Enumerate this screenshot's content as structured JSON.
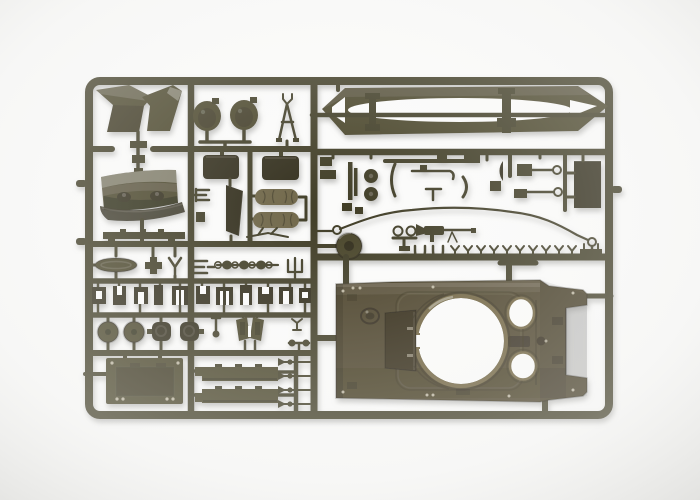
{
  "scene": {
    "type": "product-photo",
    "subject": "olive drab plastic model kit sprue",
    "description": "Product photo of an olive-drab injection-moulded model kit sprue holding tank parts: an upper hull deck with circular turret ring and two hatch openings, a pair of long tapered sand skirts, a dozer blade, stowage boxes, bed rolls, road wheels, a tow cable with end loops, rows of small brackets and fittings, all attached to a rectangular runner frame on a white studio background."
  },
  "palette": {
    "page_bg": "#fbfbfa",
    "vignette_edge": "#dddddb",
    "runner": "#413d28",
    "part_dark": "#322e1c",
    "part_mid": "#4a452c",
    "part_light": "#6d6343",
    "cylinder": "#6e6546",
    "hull": "#4c4329",
    "hull_panel": "#332b18",
    "rim_light": "#6f6440",
    "rivet_dot": "#cfc8b4"
  },
  "parts": [
    {
      "name": "sprue-frame",
      "label": "Rectangular runner frame with rounded corners"
    },
    {
      "name": "runner-rails",
      "label": "Inner runner rails dividing the sprue into bays"
    },
    {
      "name": "fender-wings",
      "label": "Angled fender / mudguard pair (top left)"
    },
    {
      "name": "hatch-discs",
      "label": "Two round hatch discs"
    },
    {
      "name": "mg-tripod",
      "label": "Machine-gun tripod A-frame"
    },
    {
      "name": "sand-skirts",
      "label": "Long tapered sand-skirt blade pair with centre rod"
    },
    {
      "name": "small-fittings",
      "label": "Cluster of small rods, rings, arcs and brackets"
    },
    {
      "name": "tow-cable",
      "label": "Long tow cable with eyelet loops at both ends"
    },
    {
      "name": "cable-pulley",
      "label": "Cable pulley wheel"
    },
    {
      "name": "hull-mg",
      "label": "Small machine gun"
    },
    {
      "name": "end-connector-row",
      "label": "Row of small track end connectors"
    },
    {
      "name": "dozer-blade",
      "label": "Curved dozer blade with hinge bosses"
    },
    {
      "name": "stowage-boxes",
      "label": "Two rounded stowage boxes"
    },
    {
      "name": "bed-rolls",
      "label": "Two rolled tarpaulins"
    },
    {
      "name": "fender-panel",
      "label": "Tall curved fender panel"
    },
    {
      "name": "oval-base-plate",
      "label": "Oval base plate"
    },
    {
      "name": "shackle-set",
      "label": "Tow shackle and ring set"
    },
    {
      "name": "bracket-row",
      "label": "Row of eleven small hull brackets"
    },
    {
      "name": "road-wheels",
      "label": "Road wheel and roller set"
    },
    {
      "name": "periscope-hoods",
      "label": "Periscope hood pair"
    },
    {
      "name": "engine-plate",
      "label": "Rectangular engine access plate with rivet holes"
    },
    {
      "name": "skirt-strips",
      "label": "Two notched skirt strips"
    },
    {
      "name": "axle-pins",
      "label": "Four axle pins"
    },
    {
      "name": "upper-hull",
      "label": "Upper hull deck with turret ring opening, notch and two round hatch openings"
    }
  ]
}
